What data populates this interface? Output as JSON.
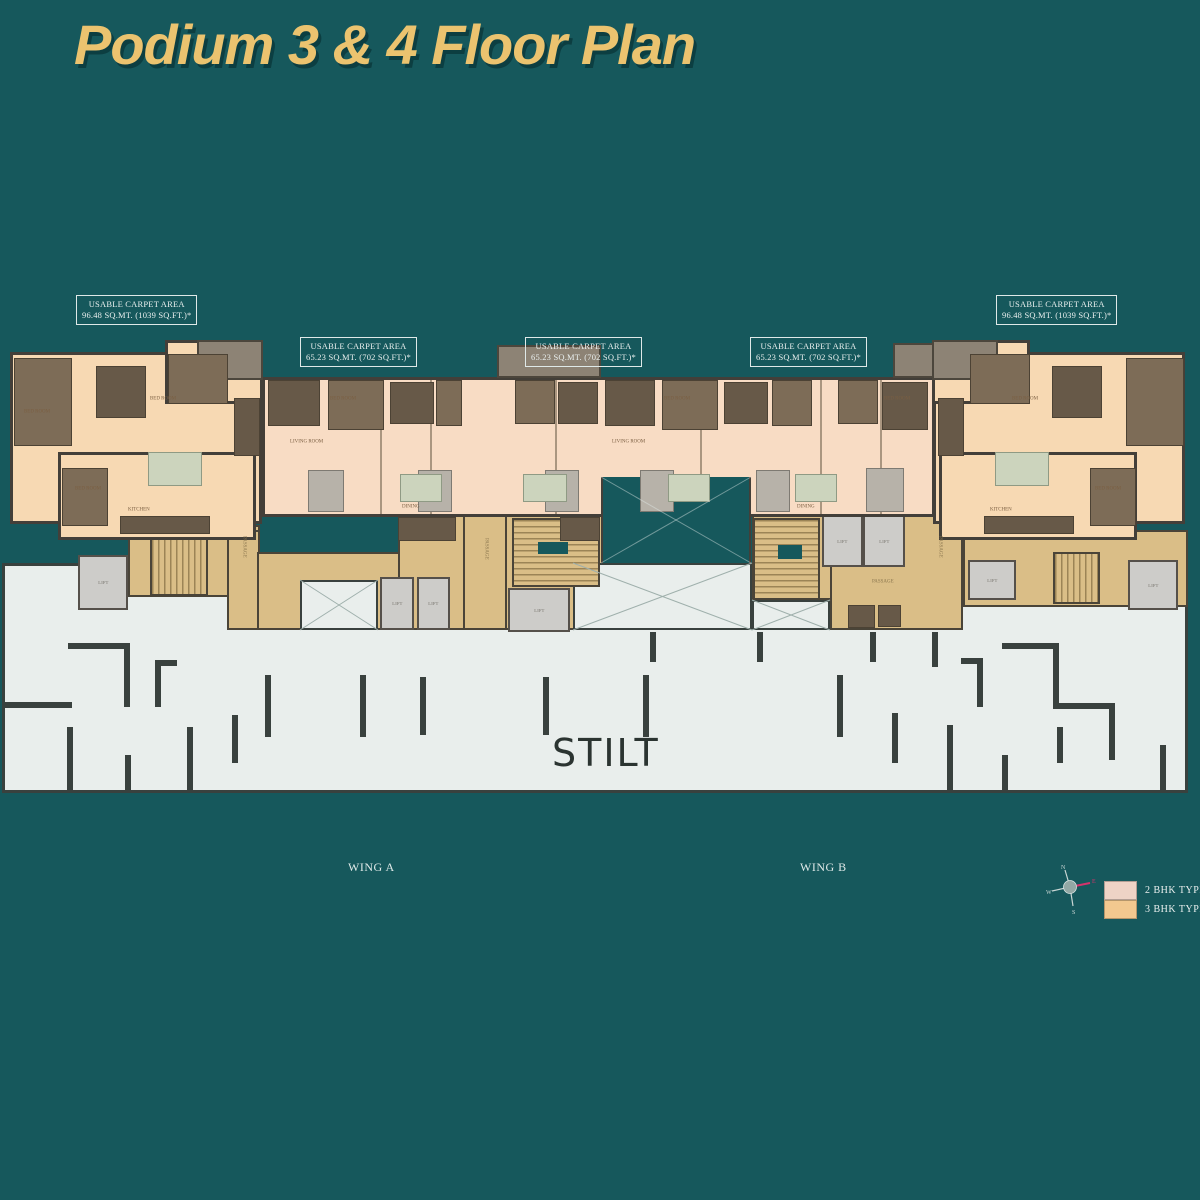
{
  "title": "Podium 3 & 4 Floor Plan",
  "area_labels": [
    {
      "line1": "USABLE CARPET AREA",
      "line2": "96.48 SQ.MT. (1039 SQ.FT.)*"
    },
    {
      "line1": "USABLE CARPET AREA",
      "line2": "65.23 SQ.MT. (702 SQ.FT.)*"
    },
    {
      "line1": "USABLE CARPET AREA",
      "line2": "65.23 SQ.MT. (702 SQ.FT.)*"
    },
    {
      "line1": "USABLE CARPET AREA",
      "line2": "65.23 SQ.MT. (702 SQ.FT.)*"
    },
    {
      "line1": "USABLE CARPET AREA",
      "line2": "96.48 SQ.MT. (1039 SQ.FT.)*"
    }
  ],
  "wings": {
    "a": "WING A",
    "b": "WING B"
  },
  "plan": {
    "stilt": "STILT",
    "passage": "PASSAGE",
    "lift": "LIFT",
    "rooms": {
      "bed": "BED ROOM",
      "living": "LIVING ROOM",
      "dining": "DINING",
      "kitchen": "KITCHEN"
    }
  },
  "legend": [
    {
      "label": "2 BHK TYPE 2",
      "color": "#eed3c6"
    },
    {
      "label": "3 BHK TYPE 1",
      "color": "#f2c88f"
    }
  ],
  "compass": {
    "n": "N",
    "e": "E",
    "s": "S",
    "w": "W"
  },
  "colors": {
    "background": "#16585c",
    "title": "#ebc36f",
    "unit_type1": "#f7d9b3",
    "unit_type2": "#f8dcc4",
    "passage": "#dabe87",
    "stilt": "#e9eeec",
    "wall": "#39413e"
  }
}
